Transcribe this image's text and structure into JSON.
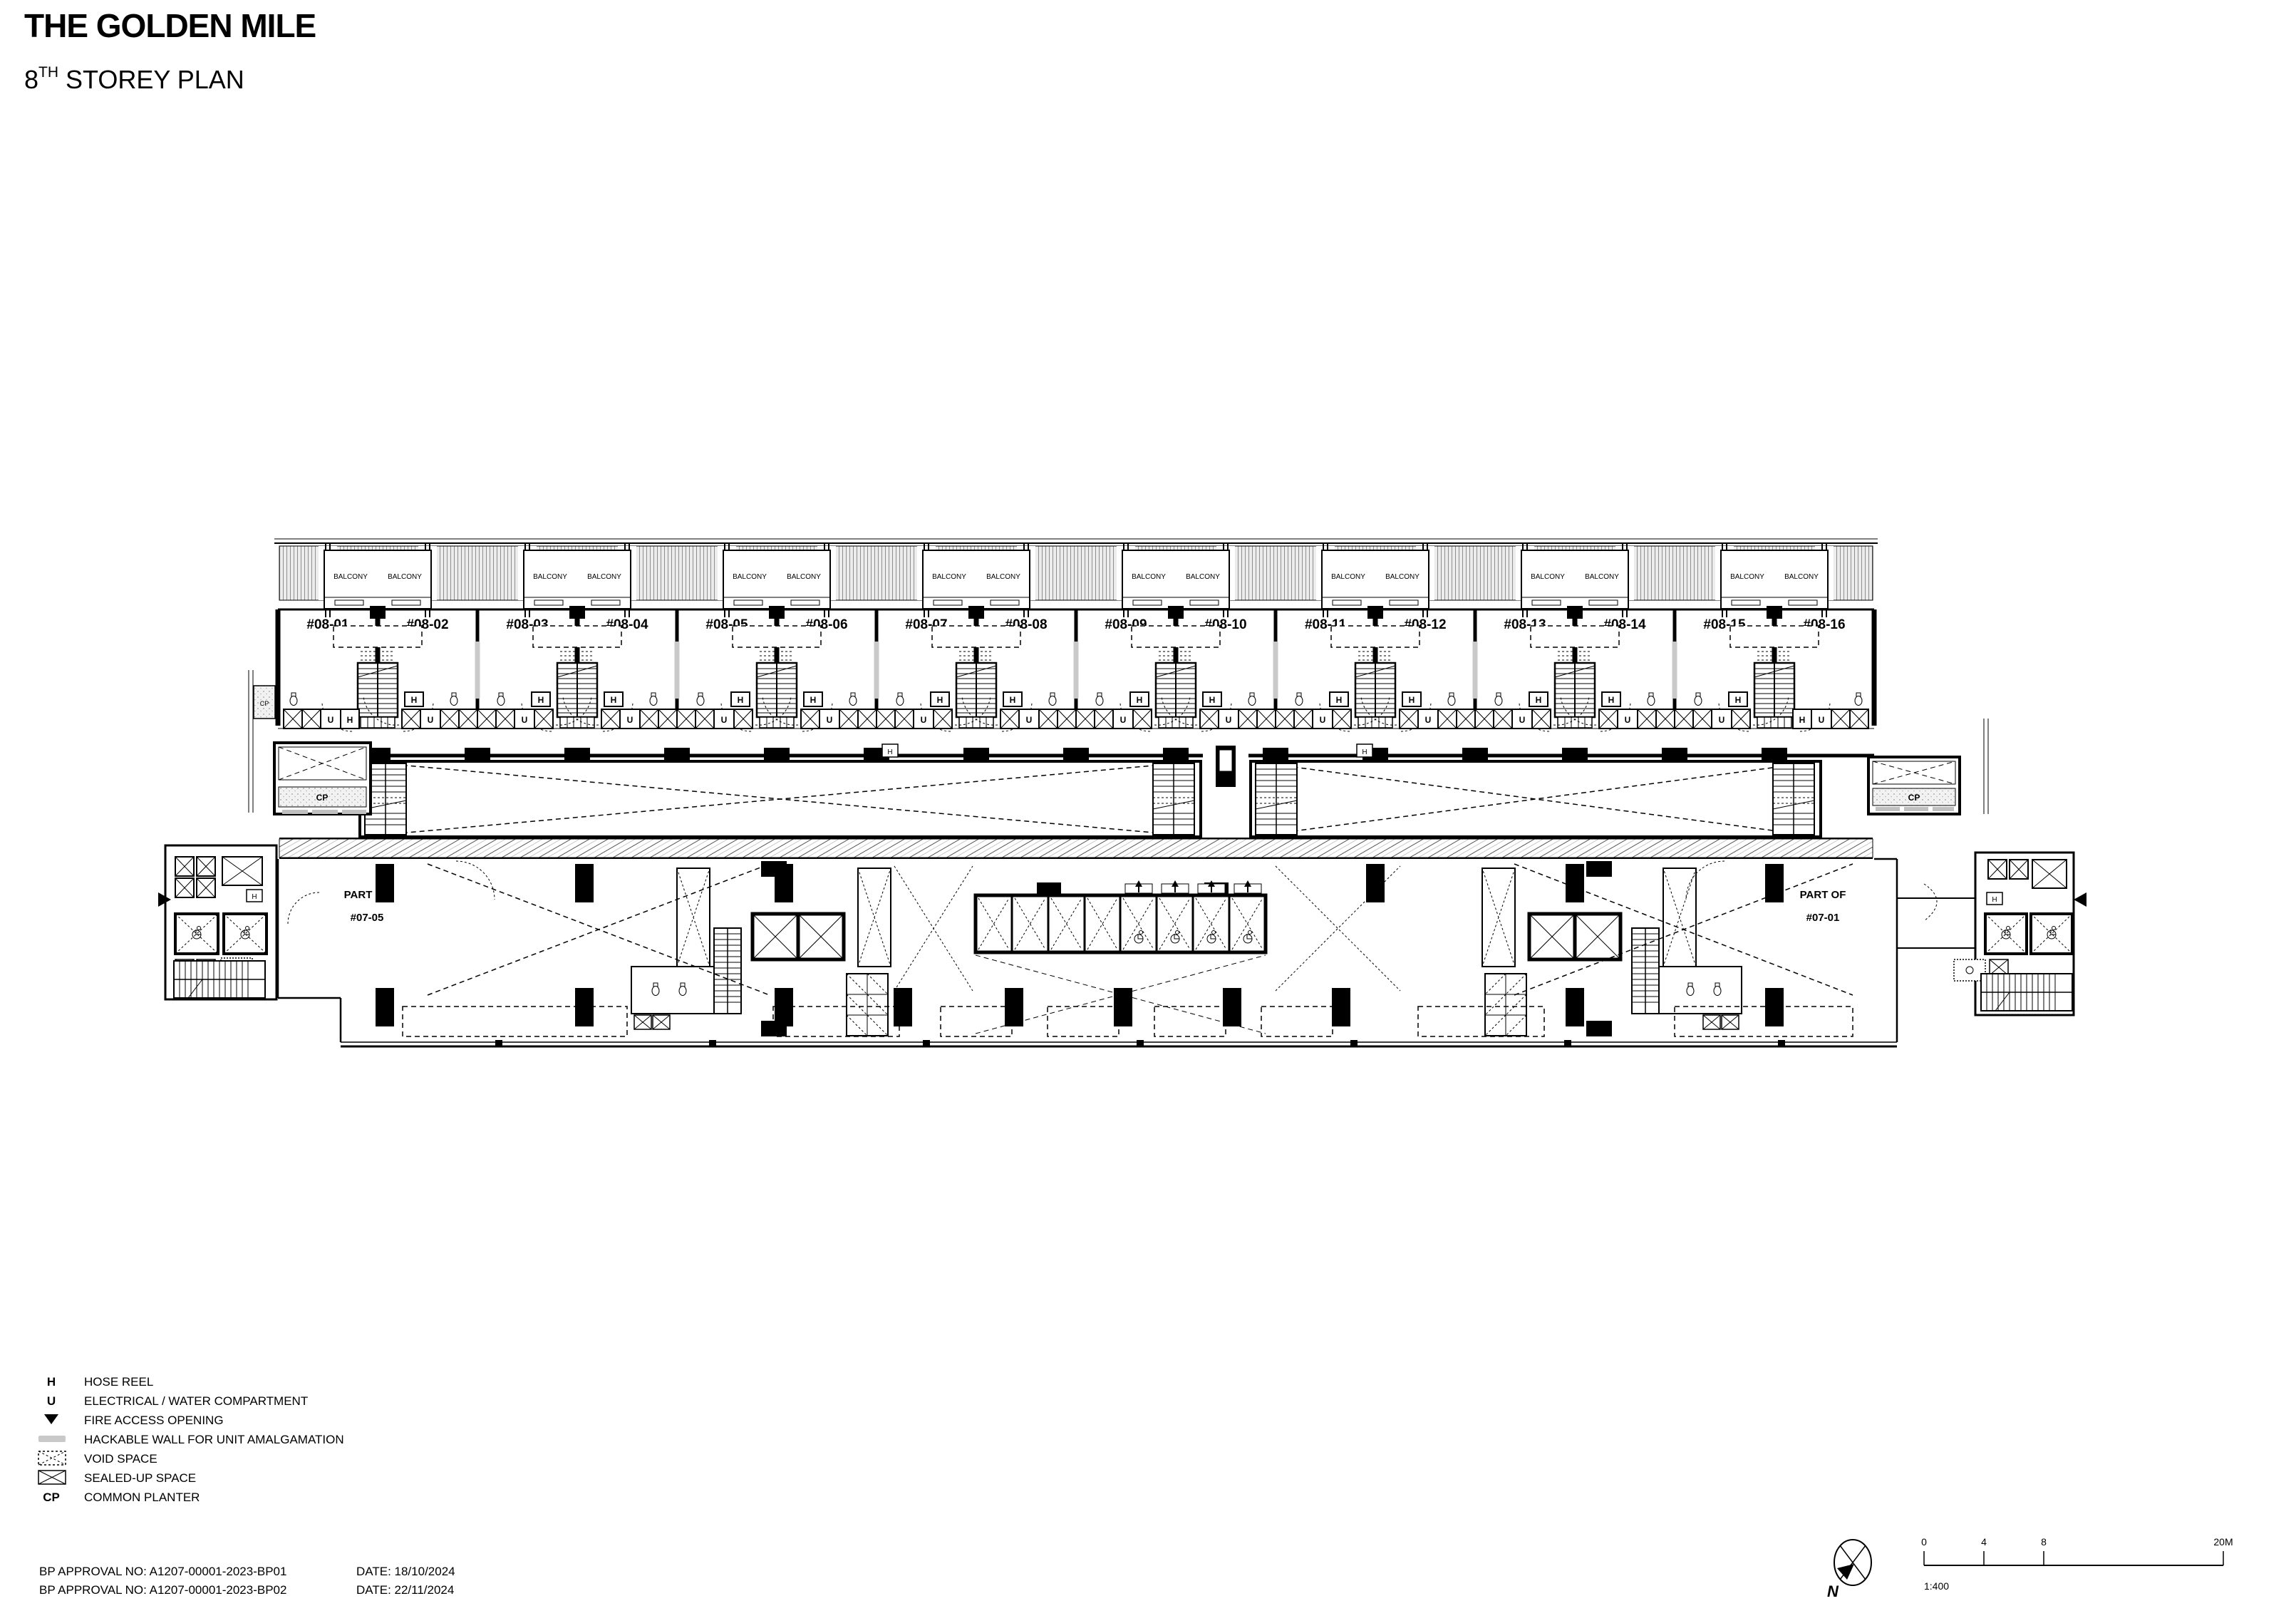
{
  "title": {
    "main": "THE GOLDEN MILE",
    "storey_num": "8",
    "storey_sup": "TH",
    "storey_rest": " STOREY PLAN"
  },
  "plan": {
    "units": [
      "#08-01",
      "#08-02",
      "#08-03",
      "#08-04",
      "#08-05",
      "#08-06",
      "#08-07",
      "#08-08",
      "#08-09",
      "#08-10",
      "#08-11",
      "#08-12",
      "#08-13",
      "#08-14",
      "#08-15",
      "#08-16"
    ],
    "balcony_label": "BALCONY",
    "sym_h": "H",
    "sym_u": "U",
    "sym_cp": "CP",
    "part_left_line1": "PART OF",
    "part_left_line2": "#07-05",
    "part_right_line1": "PART OF",
    "part_right_line2": "#07-01"
  },
  "legend": {
    "items": [
      {
        "key": "H",
        "label": "HOSE REEL"
      },
      {
        "key": "U",
        "label": "ELECTRICAL / WATER COMPARTMENT"
      },
      {
        "key": "",
        "label": "FIRE ACCESS OPENING"
      },
      {
        "key": "",
        "label": "HACKABLE WALL FOR UNIT AMALGAMATION"
      },
      {
        "key": "",
        "label": "VOID SPACE"
      },
      {
        "key": "",
        "label": "SEALED-UP SPACE"
      },
      {
        "key": "CP",
        "label": "COMMON PLANTER"
      }
    ]
  },
  "approvals": [
    {
      "label": "BP APPROVAL NO: A1207-00001-2023-BP01",
      "date": "DATE: 18/10/2024"
    },
    {
      "label": "BP APPROVAL NO: A1207-00001-2023-BP02",
      "date": "DATE: 22/11/2024"
    }
  ],
  "scale_bar": {
    "ticks": [
      "0",
      "4",
      "8",
      "20M"
    ],
    "ratio": "1:400",
    "north": "N"
  },
  "colors": {
    "ink": "#000000",
    "hackable_gray": "#c9c9c9"
  }
}
